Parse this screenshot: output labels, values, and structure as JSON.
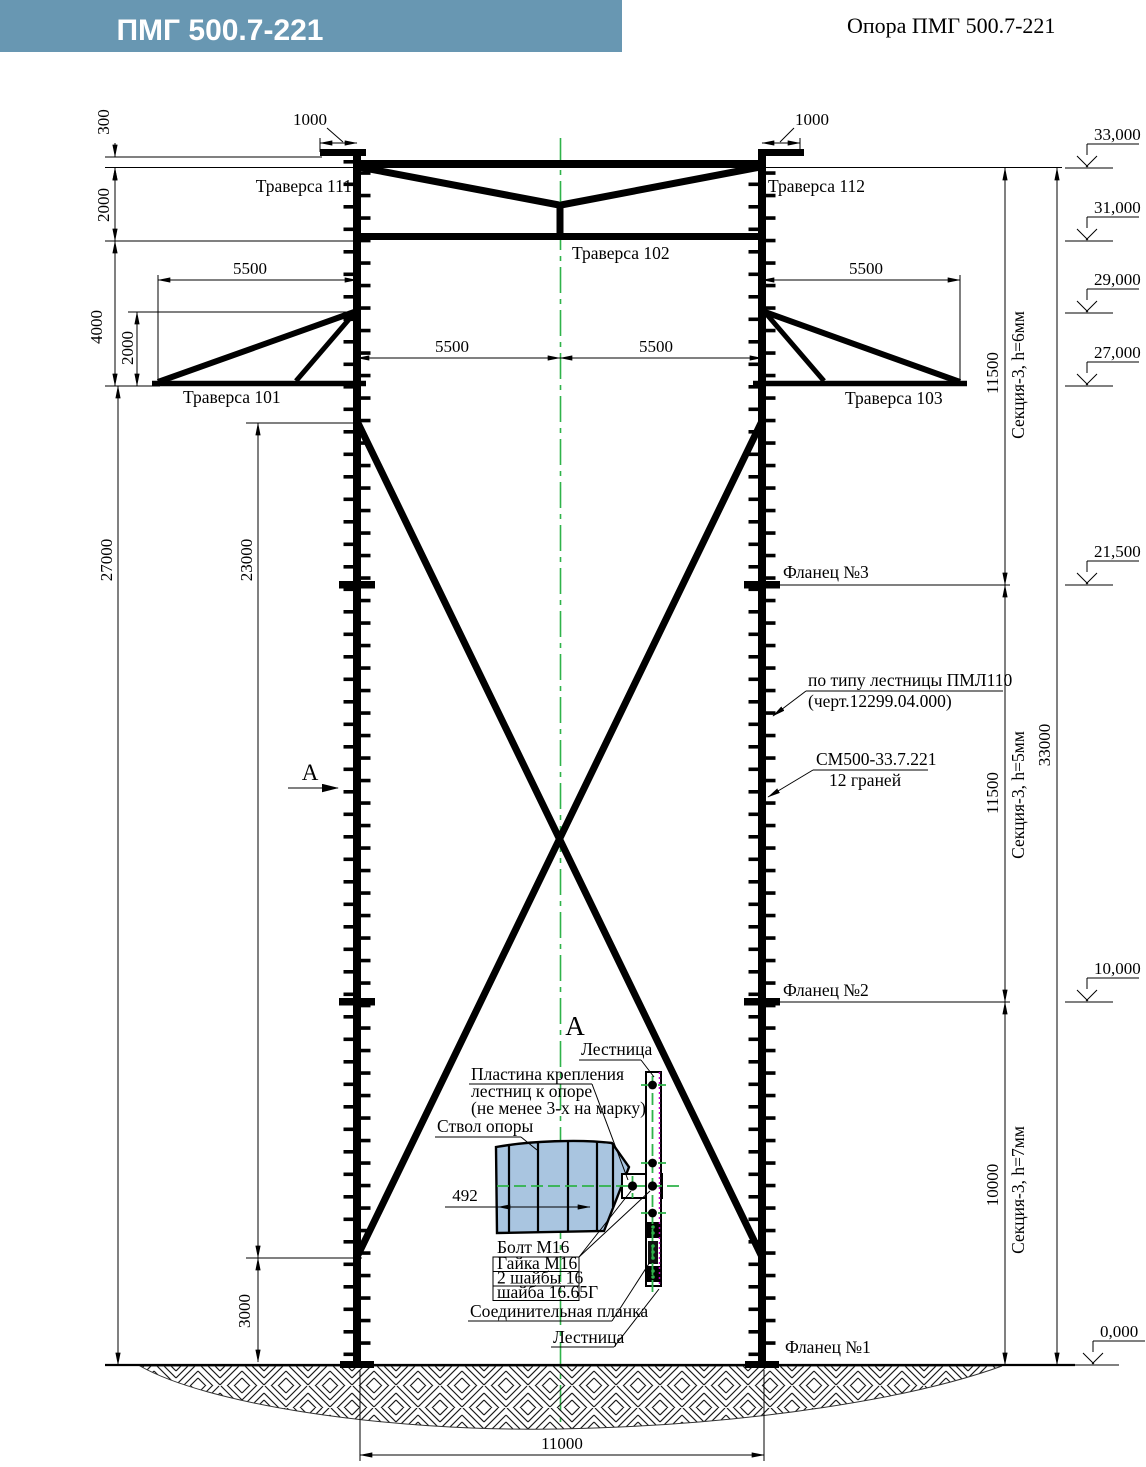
{
  "header": {
    "banner_title": "ПМГ 500.7-221",
    "doc_title": "Опора ПМГ 500.7-221"
  },
  "labels": {
    "traverse_111": "Траверса 111",
    "traverse_112": "Траверса 112",
    "traverse_102": "Траверса 102",
    "traverse_101": "Траверса 101",
    "traverse_103": "Траверса 103",
    "flange_3": "Фланец №3",
    "flange_2": "Фланец №2",
    "flange_1": "Фланец №1",
    "section_marker": "А"
  },
  "notes": {
    "ladder_note_line1": "по типу лестницы ПМЛ110",
    "ladder_note_line2": "(черт.12299.04.000)",
    "shaft_note_line1": "СМ500-33.7.221",
    "shaft_note_line2": "12 граней"
  },
  "sections": {
    "top": "Секция-3, h=6мм",
    "middle": "Секция-3, h=5мм",
    "bottom": "Секция-3, h=7мм"
  },
  "elevations": {
    "e33000": "33,000",
    "e31000": "31,000",
    "e29000": "29,000",
    "e27000": "27,000",
    "e21500": "21,500",
    "e10000": "10,000",
    "e0": "0,000"
  },
  "dimensions": {
    "d300": "300",
    "d2000_top": "2000",
    "d4000": "4000",
    "d2000_inner": "2000",
    "d1000_left": "1000",
    "d1000_right": "1000",
    "d5500_left": "5500",
    "d5500_right": "5500",
    "d5500_mid_left": "5500",
    "d5500_mid_right": "5500",
    "d27000": "27000",
    "d23000": "23000",
    "d3000": "3000",
    "d11500_top": "11500",
    "d11500_mid": "11500",
    "d10000": "10000",
    "d33000": "33000",
    "d11000": "11000",
    "d492": "492"
  },
  "detail_a": {
    "view_title": "А",
    "ladder_top": "Лестница",
    "ladder_bottom": "Лестница",
    "plate_note_line1": "Пластина крепления",
    "plate_note_line2": "лестниц к опоре",
    "plate_note_line3": "(не менее 3-х на марку)",
    "shaft_label": "Ствол опоры",
    "bolt": "Болт М16",
    "nut": "Гайка М16",
    "washers": "2 шайбы 16",
    "washer_g": "шайба 16.65Г",
    "splice_plate": "Соединительная планка"
  },
  "colors": {
    "banner": "#6897b2",
    "centerline_green": "#2fb34a",
    "shaft_fill": "#a9c5e0",
    "magenta_dotted": "#c000c0"
  }
}
